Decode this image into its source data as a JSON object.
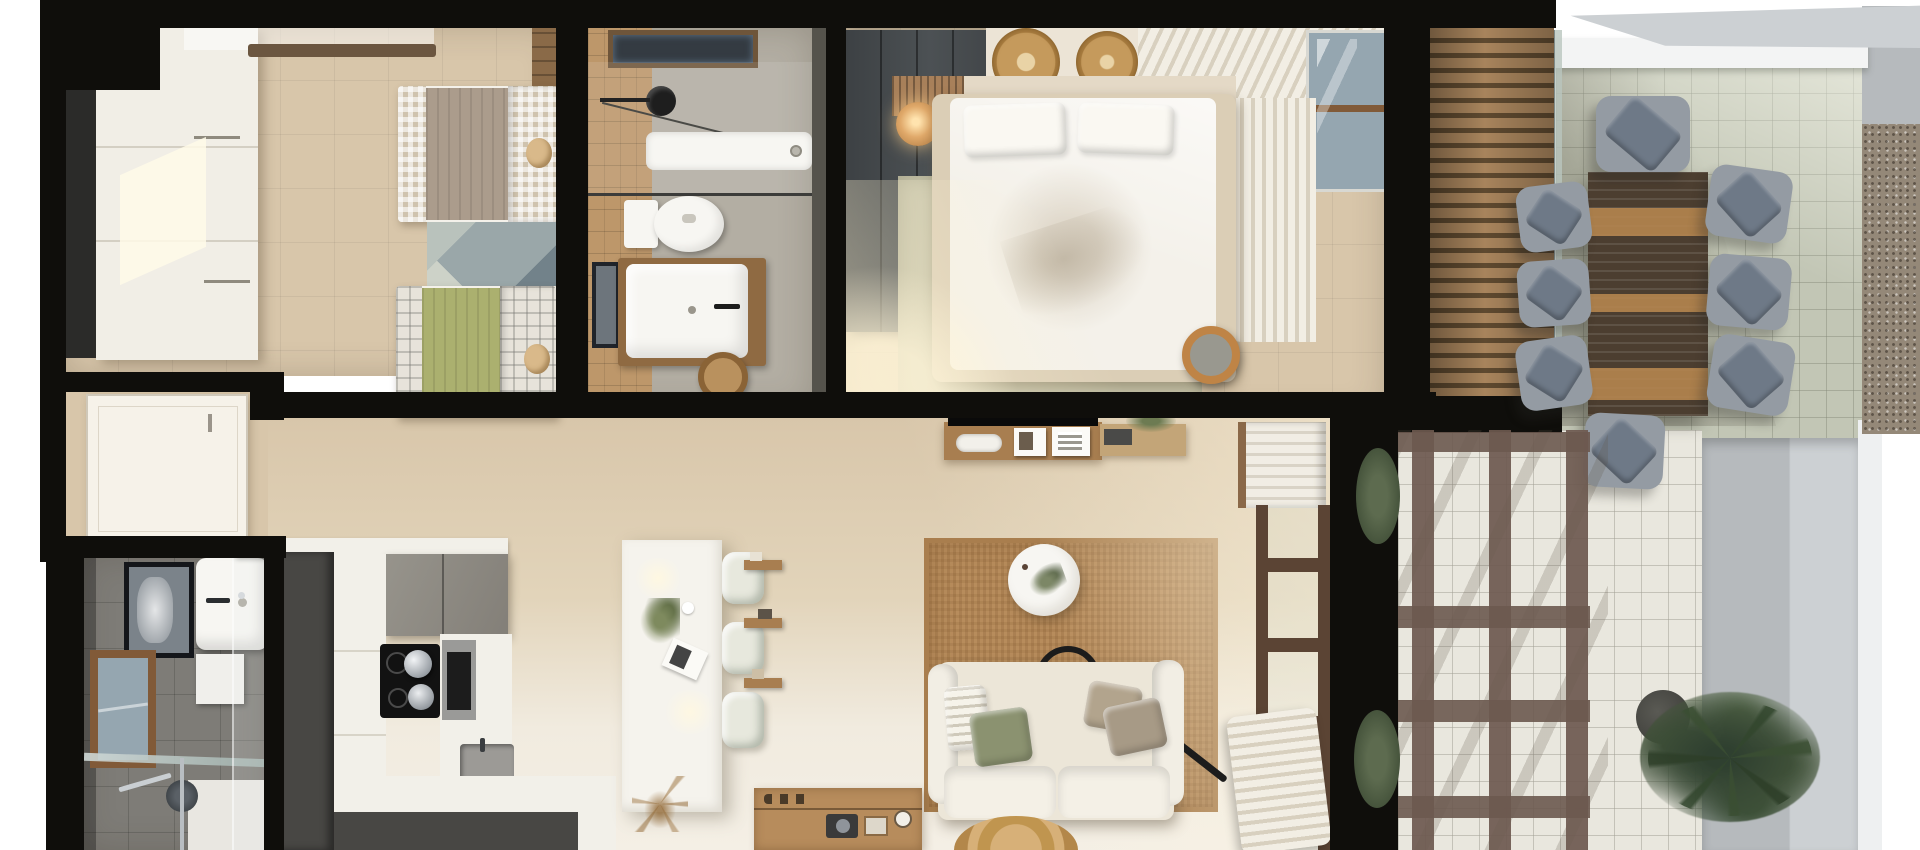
{
  "meta": {
    "kind": "top-down 3D architectural render of a one-level apartment with terrace",
    "visible_text": "none"
  },
  "palette": {
    "outside": "#ffffff",
    "wall": "#0f0e0b",
    "floor_beige": "#d8c6aa",
    "floor_beige_light": "#f1ebdf",
    "floor_bath1": "#b3aea3",
    "floor_bath2": "#7e7c77",
    "wood_tile": "#bd976a",
    "wardrobe_white": "#f1eee6",
    "wardrobe_grey": "#45494c",
    "bed_white": "#f4f1ea",
    "blanket_taupe": "#ab9c8c",
    "blanket_green": "#abb06f",
    "gingham": "#cfc3ae",
    "plaid_white": "#e7e3da",
    "rug_sage": "#c8c5ab",
    "rug_jute": "#b78c5c",
    "rug_twin": "#9aa7a9",
    "sofa_cream": "#ece6d8",
    "pillow_green": "#8b9270",
    "pillow_taupe": "#b2a48d",
    "kitchen_dark": "#484744",
    "counter_white": "#f2f0e9",
    "island_white": "#f5f3ed",
    "stool_cream": "#e7e8dd",
    "tile_terrace": "#c2c6b5",
    "tile_terrace_light": "#e9e7de",
    "pergola": "#6c594f",
    "louver_light": "#a8845c",
    "louver_dark": "#5e492f",
    "table_dark": "#4c3e30",
    "table_light": "#b5854f",
    "chair_seat": "#949ba3",
    "chair_cushion": "#6e7987",
    "gravel": "#948878",
    "grey_wall": "#b6babd",
    "grey_wall_light": "#ccd0d3",
    "plant_green": "#46573c",
    "plant_dark": "#2f4030",
    "curtain": "#f2eee4",
    "curtain_shadow": "#d8d0bf",
    "wood_shelf": "#a87e50",
    "wood_frame": "#815a38",
    "door_white": "#f6f2e9",
    "glass_blue": "#95a6b0",
    "fixture_white": "#f7f6f2",
    "tv_black": "#0a0a0a"
  },
  "scene": {
    "rooms": [
      {
        "name": "twin-bedroom",
        "furniture": [
          "white wardrobe",
          "ceiling light bar",
          "single bed taupe blanket with gingham bedding",
          "single bed green blanket with plaid duvet",
          "geometric rug",
          "wood closet shelves"
        ]
      },
      {
        "name": "bathroom-top",
        "furniture": [
          "skylight window",
          "walk-in shower with glass screen",
          "black shower head",
          "toilet",
          "wood vanity with white basin",
          "mirror",
          "wicker basket"
        ]
      },
      {
        "name": "master-bedroom",
        "furniture": [
          "grey wardrobe",
          "double bed with white duvet and two pillows",
          "slatted headboard with round lamp",
          "two rattan wall medallions",
          "sage green rug",
          "rattan pouf",
          "sheer curtains",
          "corner window"
        ]
      },
      {
        "name": "entry-hall",
        "furniture": [
          "white entrance door"
        ]
      },
      {
        "name": "bathroom-bottom",
        "furniture": [
          "white basin",
          "framed mirror",
          "wood framed window",
          "wall cabinet",
          "towel bar",
          "walk-in shower",
          "glass door"
        ]
      },
      {
        "name": "kitchen",
        "furniture": [
          "L-shaped counter",
          "dark tall cabinets",
          "grey upper cabinets",
          "induction hob with kettle and pot",
          "built-in oven",
          "sink",
          "white island",
          "three bar stools",
          "dried grass decor"
        ]
      },
      {
        "name": "living-room",
        "furniture": [
          "jute rug",
          "cream sofa with green and taupe pillows",
          "round white coffee table",
          "black arc floor lamp",
          "TV with wood shelf and frames",
          "wood bench",
          "wall shelves",
          "linen shelf with towels",
          "glazed door with wood frame",
          "sheer curtain",
          "wood sideboard with decor",
          "round jute rug"
        ]
      },
      {
        "name": "terrace",
        "furniture": [
          "wood louvered roof over stair",
          "glass balustrade",
          "slatted outdoor dining table",
          "eight outdoor chairs with blue-grey cushions",
          "brown pergola grid",
          "potted palm",
          "two bushes",
          "gravel planter strip",
          "grey privacy wall"
        ]
      }
    ]
  }
}
